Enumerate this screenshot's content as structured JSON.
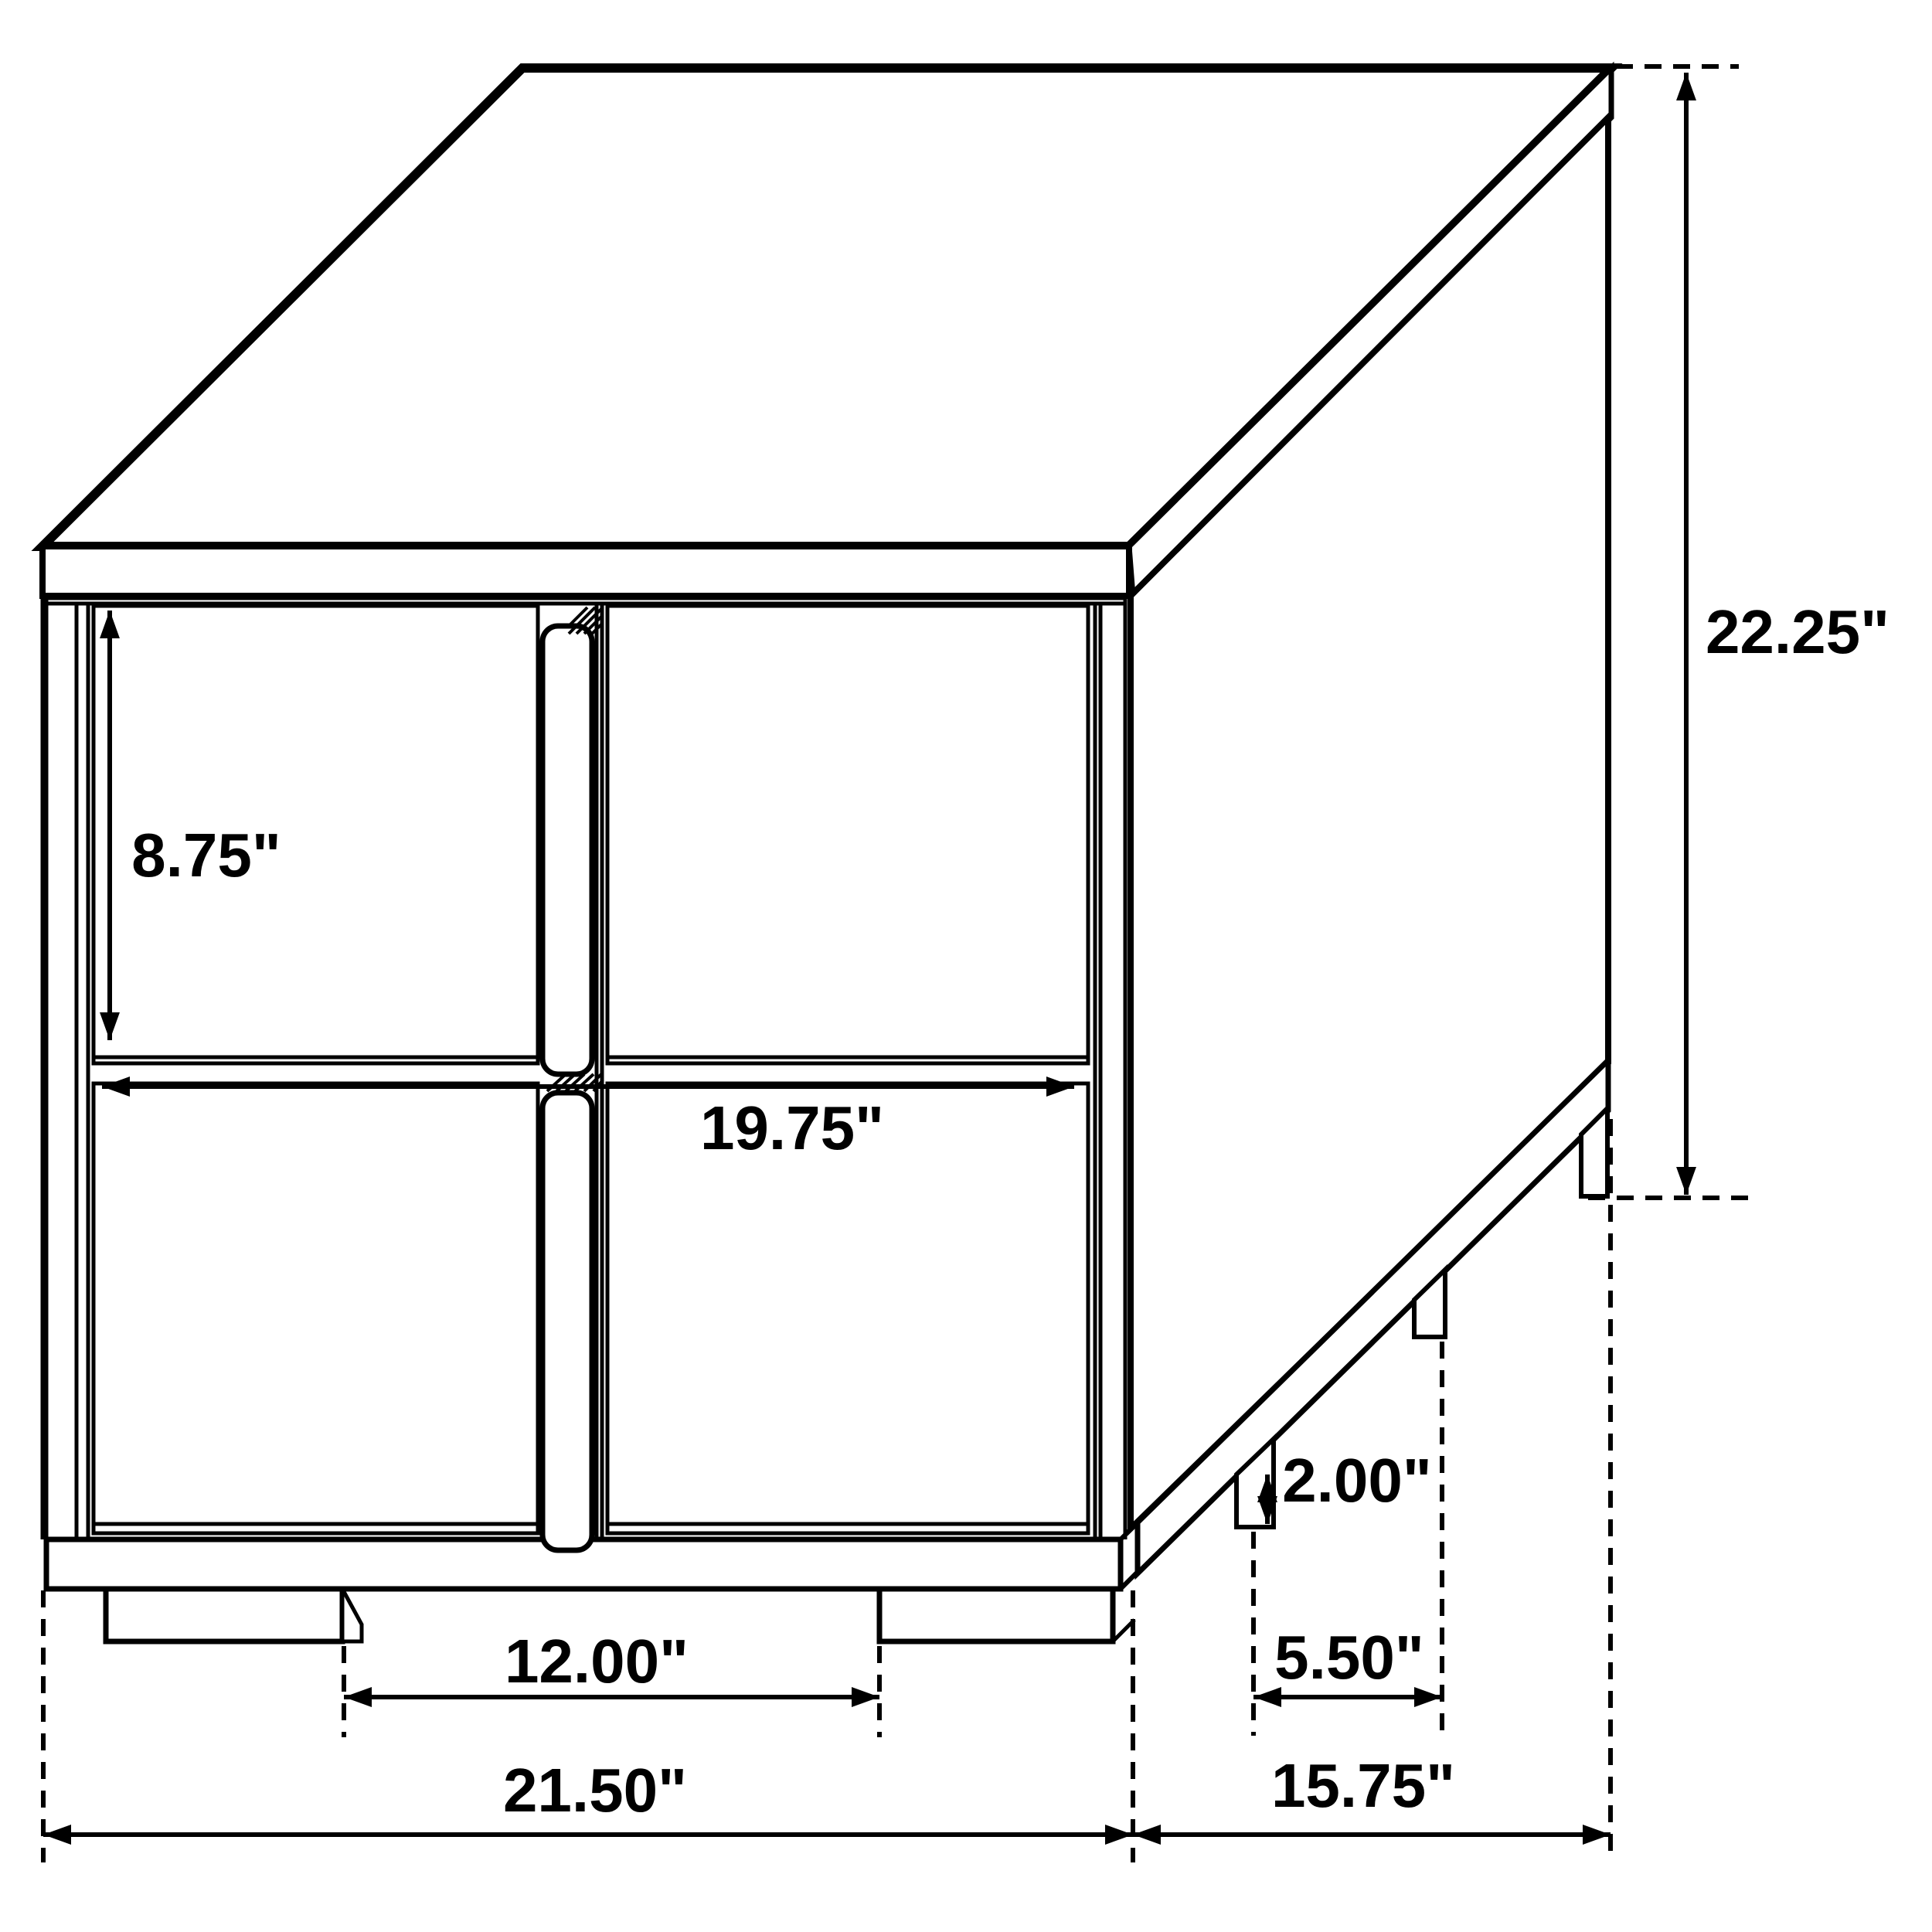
{
  "diagram": {
    "name": "nightstand-dimension-diagram",
    "object": "2-drawer nightstand line drawing",
    "colors": {
      "line": "#000000",
      "background": "#ffffff"
    },
    "units": "inches",
    "dims": {
      "height": {
        "label": "22.25\"",
        "meaning": "overall height"
      },
      "drawer_height": {
        "label": "8.75\"",
        "meaning": "drawer front height"
      },
      "drawer_width": {
        "label": "19.75\"",
        "meaning": "drawer opening width"
      },
      "leg_height": {
        "label": "2.00\"",
        "meaning": "leg height"
      },
      "front_leg_spacing": {
        "label": "12.00\"",
        "meaning": "spacing between front legs"
      },
      "side_leg_spacing": {
        "label": "5.50\"",
        "meaning": "spacing between side legs"
      },
      "width": {
        "label": "21.50\"",
        "meaning": "overall width"
      },
      "depth": {
        "label": "15.75\"",
        "meaning": "overall depth"
      }
    }
  }
}
